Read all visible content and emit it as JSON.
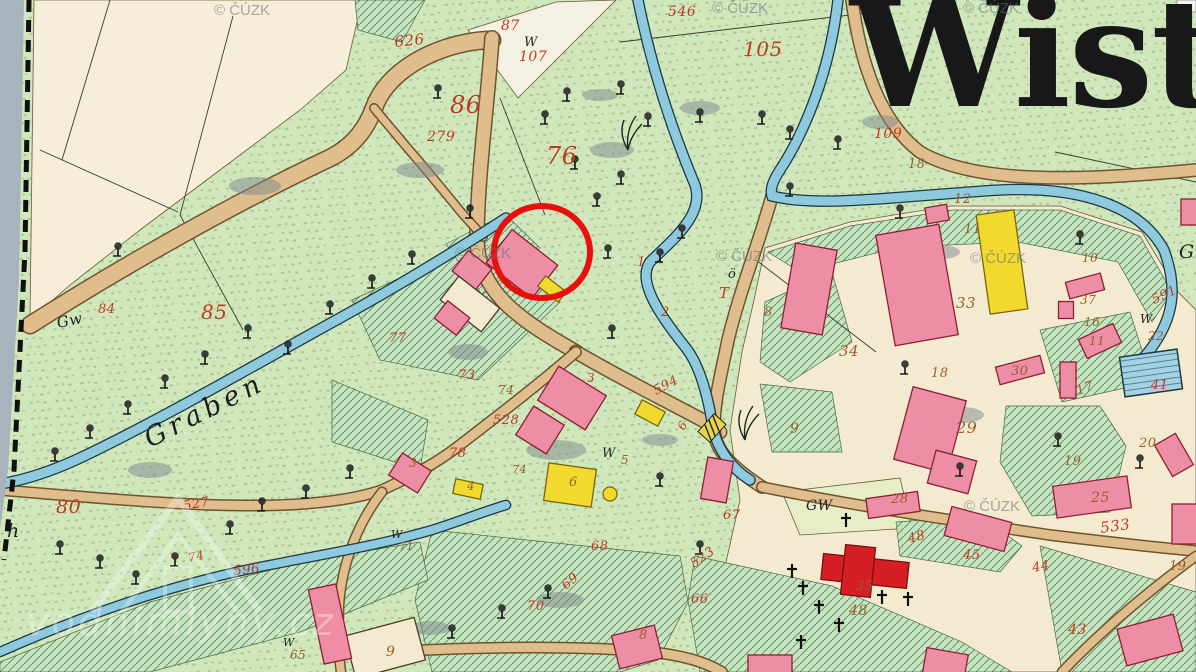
{
  "map": {
    "title": "Wistri",
    "stream_label": "Graben",
    "annotation_color": "#e8100c"
  },
  "watermarks": {
    "cuzk": "© ČÚZK",
    "site": "vodnimlyny.cz",
    "cuzk_positions": [
      [
        214,
        2
      ],
      [
        712,
        0
      ],
      [
        963,
        0
      ],
      [
        455,
        245
      ],
      [
        716,
        248
      ],
      [
        970,
        250
      ],
      [
        964,
        498
      ]
    ]
  },
  "map_render": {
    "palette": {
      "meadow": "#cfe7ba",
      "cream": "#f4ead0",
      "field": "#f6eed8",
      "white_parcel": "#f4f0e2",
      "road": "#dfbd8d",
      "road_casing": "#6e552f",
      "stream": "#8ec9de",
      "stream_casing": "#1d3a46",
      "pink": "#ee8da6",
      "pink_stroke": "#8c2033",
      "yellow": "#f2d92e",
      "yellow_stroke": "#7a660e",
      "red": "#d51f24",
      "red_stroke": "#7a0d10",
      "cream_bldg": "#f4ead0",
      "cream_bldg_stroke": "#4c3c28",
      "num_red": "#bf3a22",
      "num_brown": "#96602c",
      "num_black": "#222222",
      "edge_strip": "#a9b3be",
      "gw_field": "#e7eec7"
    },
    "cream_areas": [
      {
        "pts": "34,0 362,0 346,70 300,110 220,170 140,230 70,285 30,320",
        "fill": "#f6eed8"
      },
      {
        "pts": "468,30 556,2 616,0 518,98",
        "fill": "#f4f0e2"
      },
      {
        "pts": "765,248 850,222 950,206 1060,206 1142,232 1178,292 1196,310 1196,672 720,672 722,580 740,500 730,430 742,352 754,300",
        "fill": "#f4ead0"
      },
      {
        "pts": "782,492 900,478 912,528 800,535",
        "fill": "#e7eec7"
      }
    ],
    "hatch_areas": [
      "355,0 425,0 402,42 358,30",
      "768,252 850,226 952,210 1060,210 1140,236 1172,292 1152,322 1118,262 1018,242 900,247 800,272",
      "765,302 832,272 852,342 790,382 760,362",
      "760,384 832,392 842,452 772,452",
      "1040,330 1130,312 1152,382 1062,402",
      "1006,406 1100,406 1126,446 1110,512 1032,516 1000,462",
      "896,522 980,516 1022,546 1000,572 900,556",
      "695,556 832,586 962,642 1012,672 700,672 688,600",
      "1040,546 1196,592 1196,672 1062,672",
      "352,300 500,232 560,302 478,380 380,360",
      "332,380 428,420 420,470 332,442",
      "432,530 680,556 688,602 658,660 620,672 432,672 415,600",
      "0,662 150,602 300,562 420,542 428,580 300,632 150,672 0,672",
      "446,244 505,214 540,248 482,295"
    ],
    "field_lines": [
      [
        110,
        0,
        62,
        160
      ],
      [
        233,
        16,
        180,
        215
      ],
      [
        40,
        150,
        178,
        212
      ],
      [
        180,
        215,
        243,
        330
      ],
      [
        1055,
        152,
        1196,
        182
      ],
      [
        620,
        42,
        876,
        12
      ],
      [
        500,
        98,
        545,
        215
      ],
      [
        756,
        260,
        876,
        352
      ]
    ],
    "roads": [
      {
        "d": "M30,325 C120,268 230,205 330,158 C352,147 366,130 374,108 C383,82 410,60 446,48 C465,42 480,40 492,40",
        "w": 16
      },
      {
        "d": "M492,38 C488,100 478,170 477,235 C476,292 520,320 576,352",
        "w": 13
      },
      {
        "d": "M374,108 C402,142 432,176 456,206 C468,221 477,229 483,237",
        "w": 7
      },
      {
        "d": "M576,352 C620,378 665,400 702,420 C712,425 716,428 720,432",
        "w": 12
      },
      {
        "d": "M772,196 C760,240 740,290 728,340 C721,375 714,400 714,428 C714,452 736,470 762,487",
        "w": 11
      },
      {
        "d": "M576,352 C532,390 492,420 456,448 C432,466 408,478 382,490 C300,518 150,502 0,490",
        "w": 9
      },
      {
        "d": "M382,492 C360,520 342,560 339,606 C338,636 339,658 341,672",
        "w": 8
      },
      {
        "d": "M339,654 C450,648 560,644 650,652 C692,656 712,666 722,672",
        "w": 9
      },
      {
        "d": "M762,487 C850,505 950,520 1050,535 C1100,541 1150,547 1196,551",
        "w": 9
      },
      {
        "d": "M1196,556 C1150,590 1102,630 1062,672",
        "w": 8
      },
      {
        "d": "M852,0 C860,60 878,120 920,152 C978,186 1090,180 1196,170",
        "w": 11
      }
    ],
    "streams": [
      {
        "d": "M638,0 C652,70 672,130 695,185 C705,215 672,240 650,262 C636,282 662,318 686,348 C700,366 708,396 713,428 C718,452 734,470 750,480",
        "w": 9
      },
      {
        "d": "M838,0 C830,70 806,130 780,170 C772,182 770,190 772,196 C820,208 900,196 1000,190 C1080,186 1140,206 1164,250 C1178,288 1174,318 1150,350 C1142,360 1136,366 1130,370",
        "w": 9
      },
      {
        "d": "M506,218 C460,248 400,285 340,318 C260,362 160,420 80,458 C50,472 25,480 0,484",
        "w": 9
      },
      {
        "d": "M0,652 C90,612 180,582 270,565 C330,553 380,545 432,530 C458,522 482,512 506,505",
        "w": 8
      }
    ],
    "pond": {
      "cx": 1151,
      "cy": 373,
      "w": 58,
      "h": 40,
      "rot": -8
    },
    "bridges": [
      {
        "x": 712,
        "y": 428,
        "rot": -48
      }
    ],
    "shadows": [
      [
        255,
        186,
        26,
        9
      ],
      [
        150,
        470,
        22,
        8
      ],
      [
        420,
        170,
        24,
        8
      ],
      [
        468,
        352,
        20,
        8
      ],
      [
        556,
        450,
        30,
        10
      ],
      [
        612,
        150,
        22,
        8
      ],
      [
        700,
        108,
        20,
        7
      ],
      [
        880,
        122,
        18,
        7
      ],
      [
        940,
        252,
        20,
        7
      ],
      [
        560,
        600,
        24,
        8
      ],
      [
        430,
        628,
        20,
        7
      ],
      [
        962,
        415,
        22,
        8
      ],
      [
        600,
        95,
        18,
        6
      ],
      [
        660,
        440,
        18,
        6
      ]
    ],
    "buildings": [
      [
        522,
        264,
        58,
        42,
        38,
        "p"
      ],
      [
        552,
        289,
        26,
        13,
        38,
        "y"
      ],
      [
        472,
        270,
        30,
        26,
        38,
        "p"
      ],
      [
        470,
        304,
        52,
        30,
        38,
        "c"
      ],
      [
        452,
        318,
        28,
        22,
        38,
        "p"
      ],
      [
        572,
        398,
        56,
        40,
        32,
        "p"
      ],
      [
        540,
        430,
        36,
        34,
        32,
        "p"
      ],
      [
        410,
        473,
        34,
        26,
        32,
        "p"
      ],
      [
        468,
        489,
        28,
        15,
        12,
        "y"
      ],
      [
        570,
        485,
        48,
        38,
        8,
        "y"
      ],
      [
        650,
        413,
        26,
        16,
        28,
        "y"
      ],
      [
        717,
        480,
        26,
        42,
        10,
        "p"
      ],
      [
        809,
        289,
        42,
        86,
        10,
        "p"
      ],
      [
        917,
        285,
        64,
        112,
        -10,
        "p"
      ],
      [
        937,
        214,
        22,
        16,
        -10,
        "p"
      ],
      [
        1002,
        262,
        38,
        100,
        -8,
        "y"
      ],
      [
        1085,
        286,
        36,
        17,
        -15,
        "p"
      ],
      [
        1066,
        310,
        15,
        17,
        0,
        "p"
      ],
      [
        1100,
        341,
        38,
        21,
        -25,
        "p"
      ],
      [
        930,
        430,
        55,
        75,
        15,
        "p"
      ],
      [
        952,
        472,
        42,
        34,
        15,
        "p"
      ],
      [
        1020,
        370,
        46,
        18,
        -15,
        "p"
      ],
      [
        1068,
        380,
        16,
        36,
        0,
        "p"
      ],
      [
        1174,
        455,
        24,
        36,
        -30,
        "p"
      ],
      [
        1092,
        497,
        75,
        32,
        -8,
        "p"
      ],
      [
        893,
        505,
        52,
        20,
        -8,
        "p"
      ],
      [
        978,
        529,
        62,
        30,
        15,
        "p"
      ],
      [
        945,
        666,
        42,
        30,
        10,
        "p"
      ],
      [
        1150,
        640,
        58,
        38,
        -15,
        "p"
      ],
      [
        1186,
        524,
        28,
        40,
        0,
        "p"
      ],
      [
        385,
        648,
        72,
        44,
        -15,
        "c"
      ],
      [
        330,
        624,
        28,
        76,
        -12,
        "p"
      ],
      [
        637,
        647,
        44,
        34,
        -14,
        "p"
      ],
      [
        770,
        667,
        44,
        24,
        0,
        "p"
      ],
      [
        1190,
        212,
        18,
        26,
        0,
        "p"
      ],
      [
        865,
        571,
        86,
        26,
        6,
        "R"
      ],
      [
        858,
        571,
        30,
        50,
        6,
        "R"
      ]
    ],
    "yellow_dot": [
      610,
      494,
      7
    ],
    "trees": [
      [
        545,
        118
      ],
      [
        567,
        95
      ],
      [
        621,
        88
      ],
      [
        648,
        120
      ],
      [
        700,
        116
      ],
      [
        762,
        118
      ],
      [
        790,
        133
      ],
      [
        838,
        143
      ],
      [
        438,
        92
      ],
      [
        470,
        212
      ],
      [
        597,
        200
      ],
      [
        621,
        178
      ],
      [
        575,
        163
      ],
      [
        608,
        252
      ],
      [
        660,
        256
      ],
      [
        682,
        232
      ],
      [
        288,
        348
      ],
      [
        330,
        308
      ],
      [
        372,
        282
      ],
      [
        412,
        258
      ],
      [
        248,
        332
      ],
      [
        205,
        358
      ],
      [
        165,
        382
      ],
      [
        128,
        408
      ],
      [
        90,
        432
      ],
      [
        55,
        455
      ],
      [
        60,
        548
      ],
      [
        100,
        562
      ],
      [
        136,
        578
      ],
      [
        175,
        560
      ],
      [
        230,
        528
      ],
      [
        262,
        505
      ],
      [
        306,
        492
      ],
      [
        350,
        472
      ],
      [
        548,
        592
      ],
      [
        502,
        612
      ],
      [
        452,
        632
      ],
      [
        905,
        368
      ],
      [
        1058,
        440
      ],
      [
        1140,
        462
      ],
      [
        960,
        470
      ],
      [
        790,
        190
      ],
      [
        900,
        212
      ],
      [
        1080,
        238
      ],
      [
        612,
        332
      ],
      [
        660,
        480
      ],
      [
        700,
        548
      ],
      [
        118,
        250
      ]
    ],
    "crosses": [
      [
        792,
        572
      ],
      [
        803,
        589
      ],
      [
        819,
        608
      ],
      [
        839,
        626
      ],
      [
        882,
        598
      ],
      [
        908,
        600
      ],
      [
        801,
        643
      ],
      [
        846,
        521
      ]
    ],
    "reeds": [
      [
        628,
        150
      ],
      [
        745,
        440
      ]
    ],
    "numbers": [
      [
        "626",
        395,
        47,
        -6,
        "r",
        15
      ],
      [
        "87",
        501,
        30,
        0,
        "r",
        14
      ],
      [
        "W",
        524,
        46,
        0,
        "k",
        13
      ],
      [
        "107",
        519,
        61,
        0,
        "r",
        14
      ],
      [
        "86",
        450,
        113,
        0,
        "r",
        24
      ],
      [
        "279",
        427,
        141,
        0,
        "r",
        14
      ],
      [
        "76",
        546,
        164,
        0,
        "r",
        24
      ],
      [
        "546",
        668,
        16,
        0,
        "r",
        14
      ],
      [
        "105",
        743,
        56,
        0,
        "r",
        20
      ],
      [
        "109",
        874,
        138,
        0,
        "r",
        14
      ],
      [
        "18",
        908,
        168,
        0,
        "b",
        13
      ],
      [
        "12",
        954,
        203,
        0,
        "b",
        13
      ],
      [
        "11",
        964,
        233,
        0,
        "b",
        13
      ],
      [
        "33",
        956,
        308,
        0,
        "b",
        15
      ],
      [
        "34",
        839,
        356,
        0,
        "b",
        15
      ],
      [
        "9",
        790,
        433,
        0,
        "b",
        14
      ],
      [
        "8",
        764,
        316,
        0,
        "b",
        13
      ],
      [
        "ö",
        728,
        278,
        0,
        "k",
        13
      ],
      [
        "T",
        719,
        298,
        0,
        "r",
        15
      ],
      [
        "1",
        637,
        266,
        0,
        "r",
        13
      ],
      [
        "2",
        661,
        316,
        0,
        "r",
        13
      ],
      [
        "10",
        1082,
        262,
        0,
        "b",
        12
      ],
      [
        "37",
        1080,
        304,
        0,
        "b",
        12
      ],
      [
        "16",
        1084,
        326,
        0,
        "b",
        12
      ],
      [
        "11",
        1089,
        345,
        0,
        "b",
        12
      ],
      [
        "W",
        1140,
        323,
        0,
        "k",
        12
      ],
      [
        "22",
        1148,
        340,
        0,
        "b",
        12
      ],
      [
        "591",
        1154,
        304,
        -25,
        "r",
        13
      ],
      [
        "41",
        1151,
        389,
        0,
        "r",
        13
      ],
      [
        "Gr",
        1179,
        258,
        0,
        "k",
        19
      ],
      [
        "18",
        931,
        377,
        0,
        "b",
        13
      ],
      [
        "30",
        1011,
        375,
        0,
        "b",
        13
      ],
      [
        "29",
        956,
        433,
        0,
        "b",
        16
      ],
      [
        "17",
        1078,
        395,
        -20,
        "b",
        13
      ],
      [
        "19",
        1064,
        465,
        0,
        "b",
        13
      ],
      [
        "20",
        1139,
        447,
        0,
        "b",
        13
      ],
      [
        "25",
        1091,
        502,
        0,
        "b",
        14
      ],
      [
        "533",
        1101,
        533,
        -8,
        "r",
        15
      ],
      [
        "28",
        891,
        503,
        0,
        "b",
        13
      ],
      [
        "48",
        909,
        543,
        -15,
        "r",
        13
      ],
      [
        "45",
        963,
        559,
        0,
        "r",
        13
      ],
      [
        "44",
        1033,
        572,
        -10,
        "r",
        13
      ],
      [
        "43",
        1068,
        634,
        0,
        "r",
        14
      ],
      [
        "19",
        1169,
        570,
        0,
        "b",
        13
      ],
      [
        "35",
        856,
        590,
        0,
        "b",
        13
      ],
      [
        "48",
        849,
        615,
        0,
        "b",
        14
      ],
      [
        "GW",
        806,
        510,
        0,
        "k",
        14
      ],
      [
        "67",
        723,
        519,
        0,
        "r",
        13
      ],
      [
        "523",
        694,
        568,
        -35,
        "r",
        13
      ],
      [
        "66",
        691,
        603,
        0,
        "r",
        13
      ],
      [
        "68",
        591,
        550,
        0,
        "r",
        13
      ],
      [
        "69",
        566,
        590,
        -40,
        "r",
        13
      ],
      [
        "70",
        527,
        610,
        0,
        "r",
        13
      ],
      [
        "W",
        283,
        646,
        0,
        "k",
        11
      ],
      [
        "65",
        290,
        659,
        0,
        "b",
        12
      ],
      [
        "9",
        386,
        656,
        0,
        "b",
        14
      ],
      [
        "8",
        639,
        639,
        0,
        "b",
        13
      ],
      [
        "W",
        602,
        457,
        0,
        "k",
        13
      ],
      [
        "5",
        621,
        464,
        0,
        "b",
        12
      ],
      [
        "6",
        569,
        486,
        0,
        "b",
        13
      ],
      [
        "4",
        467,
        490,
        0,
        "b",
        12
      ],
      [
        "3",
        409,
        467,
        0,
        "b",
        12
      ],
      [
        "3",
        587,
        382,
        0,
        "r",
        12
      ],
      [
        "74",
        512,
        473,
        0,
        "b",
        11
      ],
      [
        "73",
        458,
        379,
        0,
        "r",
        13
      ],
      [
        "74",
        498,
        394,
        0,
        "b",
        12
      ],
      [
        "528",
        493,
        424,
        0,
        "r",
        13
      ],
      [
        "78",
        449,
        457,
        0,
        "r",
        13
      ],
      [
        "77",
        389,
        342,
        0,
        "r",
        13
      ],
      [
        "594",
        656,
        395,
        -28,
        "r",
        13
      ],
      [
        "84",
        98,
        313,
        0,
        "r",
        13
      ],
      [
        "85",
        201,
        319,
        0,
        "r",
        20
      ],
      [
        "Gw",
        58,
        328,
        -12,
        "k",
        15
      ],
      [
        "80",
        56,
        513,
        0,
        "r",
        19
      ],
      [
        "527",
        184,
        510,
        -10,
        "r",
        13
      ],
      [
        "74",
        189,
        562,
        -12,
        "r",
        12
      ],
      [
        "596",
        234,
        575,
        -6,
        "r",
        13
      ],
      [
        "h",
        7,
        537,
        0,
        "k",
        19
      ],
      [
        "W",
        391,
        538,
        0,
        "k",
        11
      ],
      [
        "71",
        399,
        550,
        0,
        "b",
        11
      ],
      [
        "6",
        684,
        431,
        -60,
        "r",
        12
      ]
    ],
    "annotation": {
      "cx": 542,
      "cy": 252,
      "rx": 48,
      "ry": 46,
      "stroke_w": 6
    },
    "edge_strip_pts": "0,0 24,0 19,280 8,470 0,530",
    "edge_dash": "29,0 25,250 14,470 4,560",
    "corner_notch": [
      1177,
      0,
      19,
      12
    ]
  }
}
